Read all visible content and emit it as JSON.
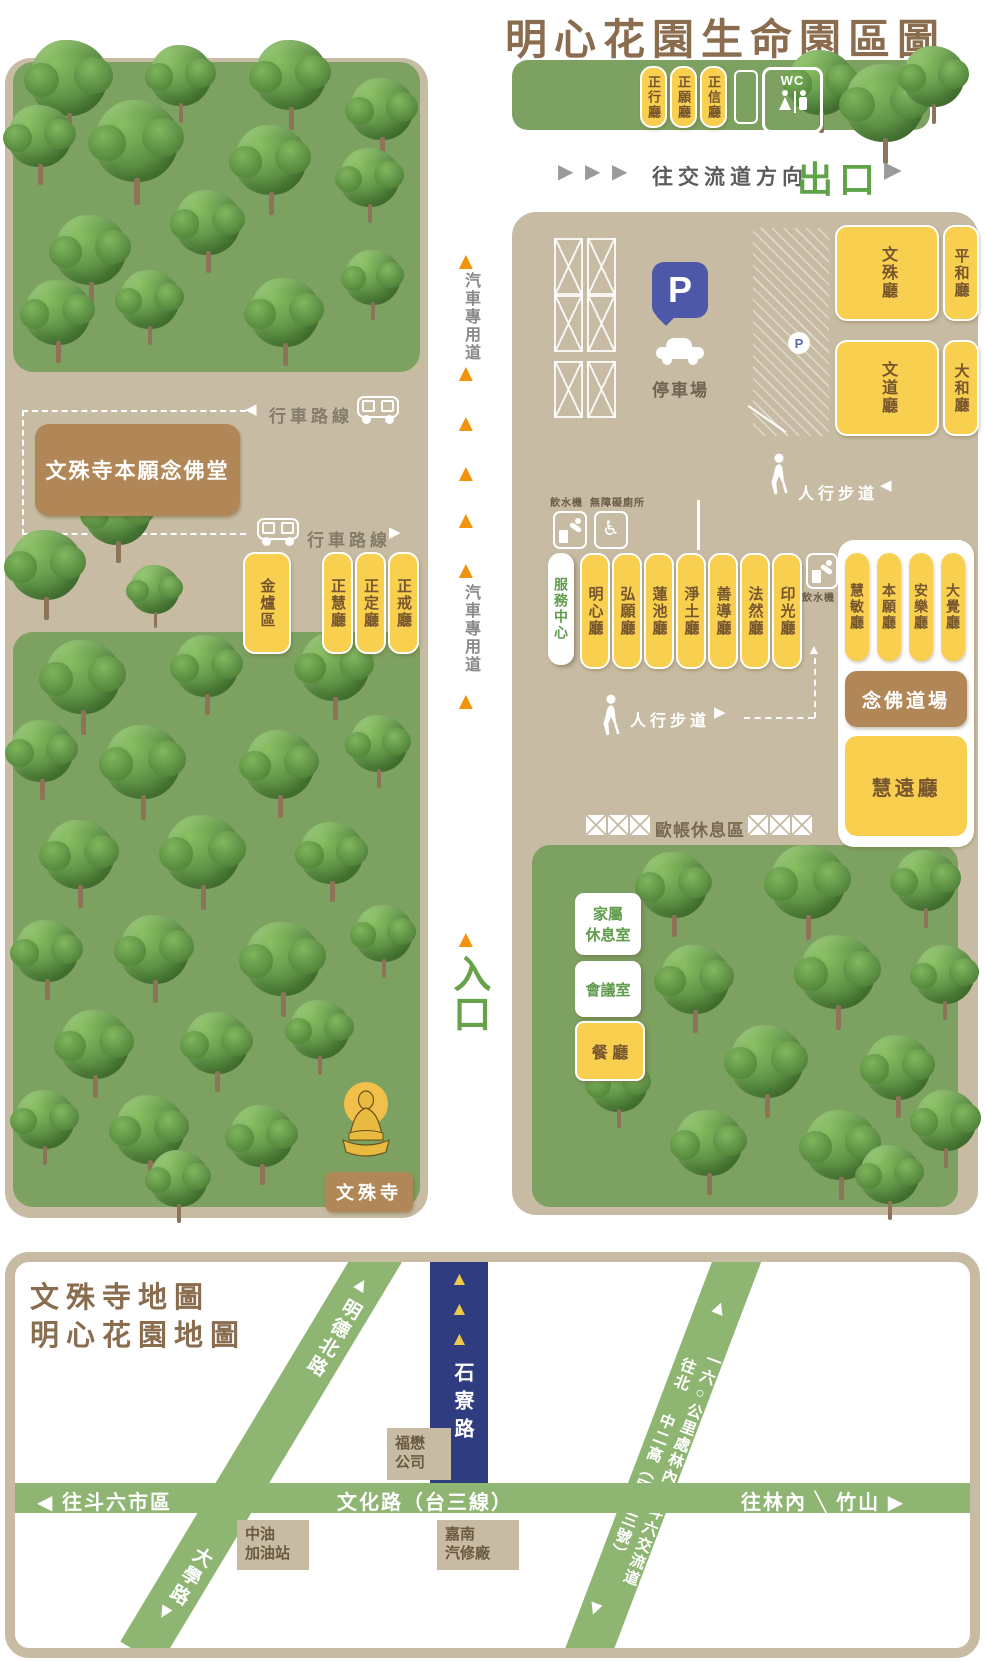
{
  "title": "明心花園生命園區圖",
  "icons": {
    "up_triangle": "▲",
    "down_triangle": "▼",
    "left_triangle": "◀",
    "right_triangle": "▶",
    "fork_slash": "╲",
    "wheelchair": "♿"
  },
  "colors": {
    "tan": "#c7bca3",
    "park_green": "#7da161",
    "hall_yellow": "#f9cf4f",
    "hall_text": "#76562f",
    "brown_box": "#b28757",
    "title_brown": "#8a6c4e",
    "road_green": "#8fb573",
    "road_navy": "#2f3c80",
    "orange_arrow": "#f2930d",
    "exit_green": "#5fa348",
    "p_blue": "#4d59a8"
  },
  "top_bar": {
    "halls": [
      "正行廳",
      "正願廳",
      "正信廳"
    ],
    "wc": "WC"
  },
  "exit_row": {
    "direction": "往交流道方向",
    "exit": "出口"
  },
  "vehicle_road": {
    "label": "汽車專用道",
    "entrance": "入口"
  },
  "left_map": {
    "route": "行車路線",
    "main_hall": "文殊寺本願念佛堂",
    "incinerator": "金爐區",
    "halls": [
      "正慧廳",
      "正定廳",
      "正戒廳"
    ],
    "temple": "文殊寺"
  },
  "right_map": {
    "p_sign": "P",
    "parking": "停車場",
    "halls_top": [
      "文殊廳",
      "平和廳",
      "文道廳",
      "大和廳"
    ],
    "walkway": "人行步道",
    "water": "飲水機",
    "accessible": "無障礙廁所",
    "service_center": "服務中心",
    "halls_mid": [
      "明心廳",
      "弘願廳",
      "蓮池廳",
      "淨土廳",
      "善導廳",
      "法然廳",
      "印光廳"
    ],
    "halls_right": [
      "慧敏廳",
      "本願廳",
      "安樂廳",
      "大覺廳"
    ],
    "nembutsu": "念佛道場",
    "huiyuan": "慧遠廳",
    "tent_rest": "歐帳休息區",
    "family_room": [
      "家屬",
      "休息室"
    ],
    "meeting_room": "會議室",
    "dining": "餐 廳"
  },
  "road_map": {
    "title_lines": [
      "文殊寺地圖",
      "明心花園地圖"
    ],
    "mingde_rd": "明德北路",
    "daxue_rd": "大學路",
    "shiliao_rd": "石寮路",
    "wenhua_rd": "文化路（台三線）",
    "to_douliu": "往斗六市區",
    "to_linnei": "往林內",
    "zhushan": "竹山",
    "highway_left": [
      "往北",
      "中二高（國道三號）"
    ],
    "highway_right": [
      "一六○公里處林內",
      "斗六交流道"
    ],
    "fumao": [
      "福懋",
      "公司"
    ],
    "cpc": [
      "中油",
      "加油站"
    ],
    "jianan": [
      "嘉南",
      "汽修廠"
    ]
  }
}
